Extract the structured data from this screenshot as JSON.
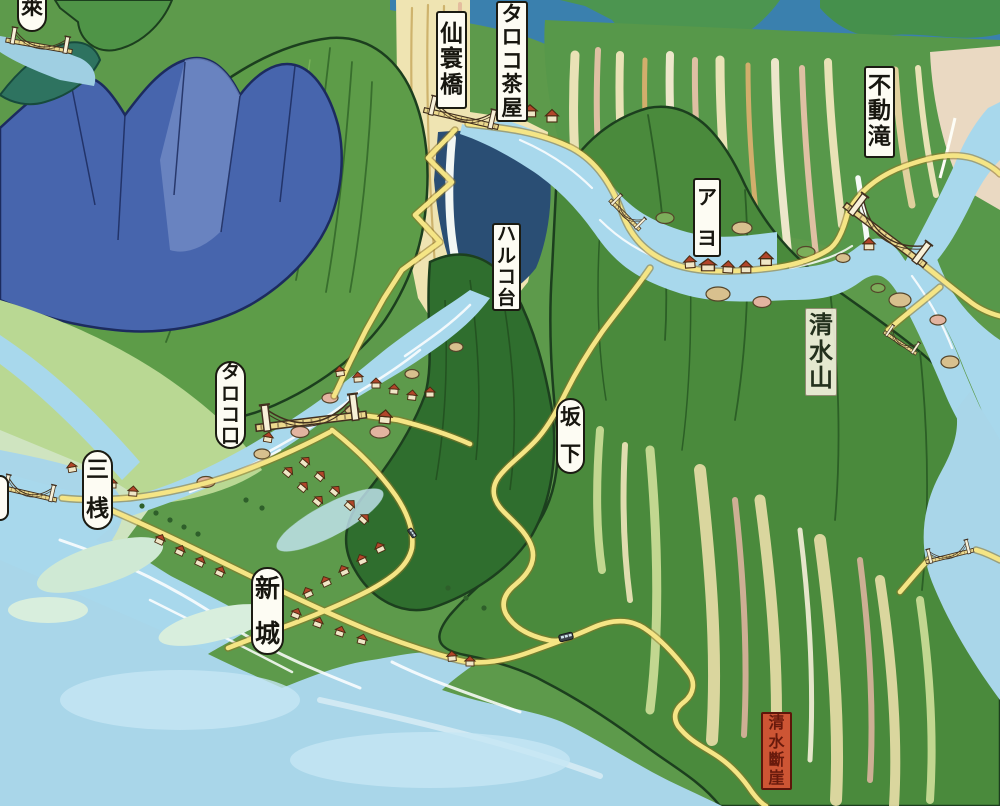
{
  "map": {
    "labels": [
      {
        "id": "rai",
        "text": "萊",
        "x": 17,
        "y": -16,
        "w": 30,
        "h": 48,
        "variant": "pill",
        "spread": false
      },
      {
        "id": "senkankyo",
        "text": "仙寰橋",
        "x": 436,
        "y": 11,
        "w": 31,
        "h": 98,
        "variant": "rect",
        "spread": false
      },
      {
        "id": "taroko-chaya",
        "text": "タロコ茶屋",
        "x": 496,
        "y": 1,
        "w": 32,
        "h": 121,
        "variant": "rect",
        "spread": false
      },
      {
        "id": "fudo-taki",
        "text": "不動滝",
        "x": 864,
        "y": 66,
        "w": 31,
        "h": 92,
        "variant": "rect",
        "spread": false
      },
      {
        "id": "ayo",
        "text": "アヨ",
        "x": 693,
        "y": 178,
        "w": 28,
        "h": 79,
        "variant": "rect",
        "spread": true
      },
      {
        "id": "haruko-dai",
        "text": "ハルコ台",
        "x": 492,
        "y": 223,
        "w": 29,
        "h": 88,
        "variant": "rect",
        "spread": false
      },
      {
        "id": "shimizu-yama",
        "text": "清水山",
        "x": 805,
        "y": 308,
        "w": 32,
        "h": 88,
        "variant": "plain",
        "spread": false
      },
      {
        "id": "taroko-guchi",
        "text": "タロコ口",
        "x": 215,
        "y": 361,
        "w": 31,
        "h": 88,
        "variant": "pill",
        "spread": false
      },
      {
        "id": "sakashita",
        "text": "坂下",
        "x": 556,
        "y": 398,
        "w": 29,
        "h": 76,
        "variant": "pill",
        "spread": true
      },
      {
        "id": "sansan",
        "text": "三桟",
        "x": 82,
        "y": 450,
        "w": 31,
        "h": 80,
        "variant": "pill",
        "spread": true
      },
      {
        "id": "shinjo",
        "text": "新城",
        "x": 251,
        "y": 567,
        "w": 33,
        "h": 88,
        "variant": "pill",
        "spread": true
      },
      {
        "id": "shimizu-dangai",
        "text": "清水斷崖",
        "x": 761,
        "y": 712,
        "w": 31,
        "h": 78,
        "variant": "red",
        "spread": false
      }
    ],
    "icons": {
      "suspension-bridge-icon": "towers + sagging cable shape",
      "house-icon": "⌂",
      "bus-icon": "▭",
      "waterfall-icon": "≋",
      "rock-icon": "●",
      "tree-icon": "•"
    },
    "colors": {
      "water": "#a9d6e9",
      "foam_white": "#ffffff",
      "shallow_green": "#cfe9d4",
      "mountain_blue": "#4765ad",
      "mountain_green_bright": "#5d9c48",
      "mountain_green_dark": "#2f6e2e",
      "cliff_cream": "#efe4b2",
      "cliff_pink": "#e2b4a0",
      "road_yellow": "#f5e585",
      "roof_red": "#b2452a",
      "label_bg": "#fdfcf3",
      "label_border": "#1b1b12",
      "danger_label_bg": "#cd5534",
      "danger_label_border": "#5e150a"
    }
  }
}
